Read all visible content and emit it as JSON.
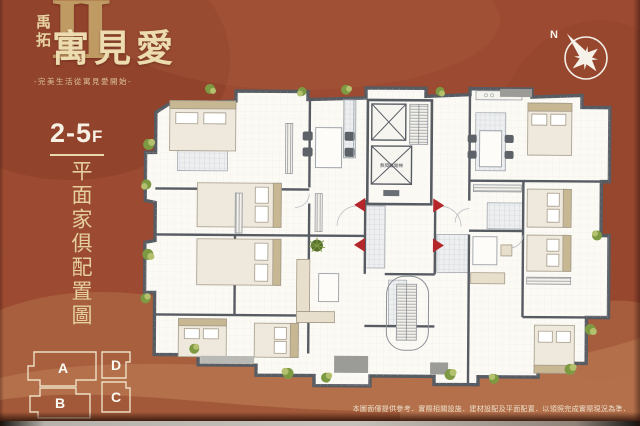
{
  "brand": {
    "developer": "禹拓",
    "name": "寓見愛",
    "numeral": "II",
    "tagline": "-完美生活從寓見愛開始-"
  },
  "floor_badge": {
    "range": "2-5",
    "suffix": "F"
  },
  "plan_title": "平面家俱配置圖",
  "compass": {
    "north": "N"
  },
  "key_plan": {
    "units": [
      {
        "label": "A"
      },
      {
        "label": "B"
      },
      {
        "label": "D"
      },
      {
        "label": "C"
      }
    ]
  },
  "floor_plan": {
    "elevator_label": "無障礙電梯"
  },
  "disclaimer": "本圖面僅提供參考．實際相關設施．建材設配及平面配置．以領照完成實際現況為準．",
  "colors": {
    "background": "#9c4a31",
    "accent_gold": "#e5cf9e",
    "wall_gray": "#575c63",
    "door_red": "#b5262b",
    "plant_green": "#7d9a43"
  }
}
